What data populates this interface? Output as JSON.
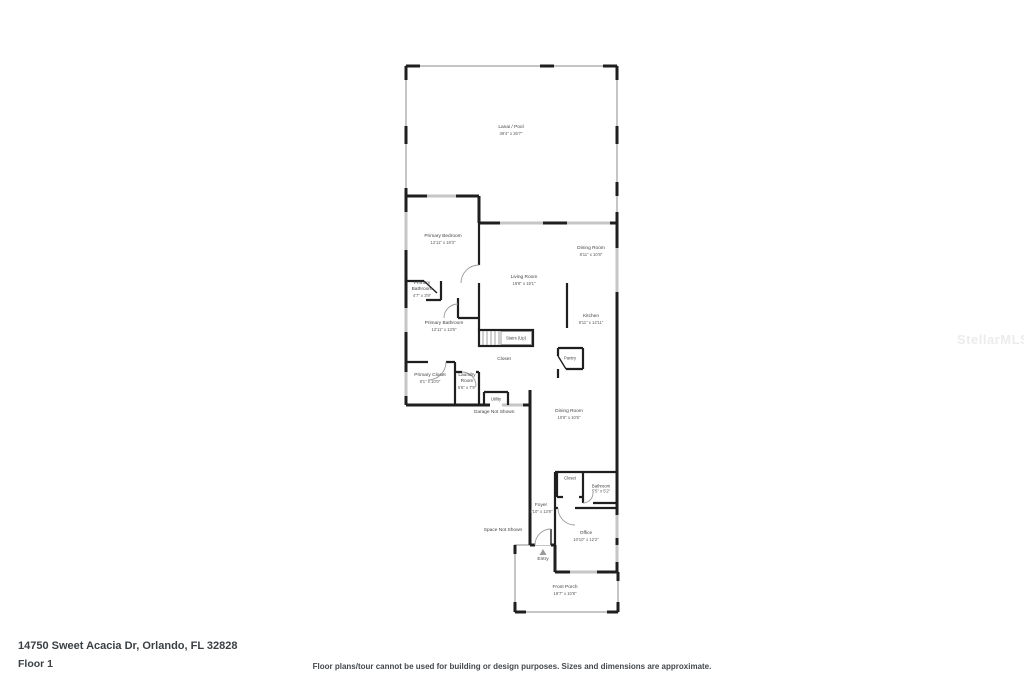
{
  "watermark": {
    "text": "StellarMLS",
    "color": "#ececec"
  },
  "footer": {
    "address": "14750 Sweet Acacia Dr, Orlando, FL 32828",
    "floor_label": "Floor 1",
    "disclaimer": "Floor plans/tour cannot be used for building or design purposes. Sizes and dimensions are approximate."
  },
  "floorplan": {
    "colors": {
      "wall": "#1f1f1f",
      "window": "#c6c6c6",
      "screen": "#bfbfbf",
      "arc": "#9a9a9a",
      "label": "#3f4347",
      "hatch_fill": "#f7f7f7",
      "hatch_line": "#e3e3e3",
      "watermark": "#ececec"
    },
    "rooms": [
      {
        "id": "lanai-pool",
        "name": "Lanai / Pool",
        "dims": "39'4\" x 26'7\""
      },
      {
        "id": "primary-bedroom",
        "name": "Primary Bedroom",
        "dims": "12'11\" x 19'3\""
      },
      {
        "id": "living-room",
        "name": "Living Room",
        "dims": "19'8\" x 19'1\""
      },
      {
        "id": "dining-room-upper",
        "name": "Dining Room",
        "dims": "8'11\" x 10'8\""
      },
      {
        "id": "kitchen",
        "name": "Kitchen",
        "dims": "8'11\" x 14'11\""
      },
      {
        "id": "primary-bathroom-wc",
        "name": "Primary Bathroom",
        "dims": "4'7\" x 3'9\""
      },
      {
        "id": "primary-bathroom",
        "name": "Primary Bathroom",
        "dims": "12'11\" x 13'6\""
      },
      {
        "id": "stairs",
        "name": "Stairs (Up)",
        "dims": ""
      },
      {
        "id": "closet-under-stairs",
        "name": "Closet",
        "dims": ""
      },
      {
        "id": "pantry",
        "name": "Pantry",
        "dims": ""
      },
      {
        "id": "primary-closet",
        "name": "Primary Closet",
        "dims": "8'1\" x 10'0\""
      },
      {
        "id": "laundry-room",
        "name": "Laundry Room",
        "dims": "5'6\" x 7'9\""
      },
      {
        "id": "utility",
        "name": "Utility",
        "dims": ""
      },
      {
        "id": "garage-note",
        "name": "Garage Not Shown",
        "dims": ""
      },
      {
        "id": "dining-room-lower",
        "name": "Dining Room",
        "dims": "10'6\" x 10'6\""
      },
      {
        "id": "closet-lower",
        "name": "Closet",
        "dims": ""
      },
      {
        "id": "bathroom",
        "name": "Bathroom",
        "dims": "5'5\" x 5'2\""
      },
      {
        "id": "foyer",
        "name": "Foyer",
        "dims": "4'10\" x 13'9\""
      },
      {
        "id": "space-note",
        "name": "Space Not Shown",
        "dims": ""
      },
      {
        "id": "office",
        "name": "Office",
        "dims": "10'10\" x 12'2\""
      },
      {
        "id": "entry",
        "name": "Entry",
        "dims": ""
      },
      {
        "id": "front-porch",
        "name": "Front Porch",
        "dims": "18'7\" x 10'8\""
      }
    ]
  }
}
